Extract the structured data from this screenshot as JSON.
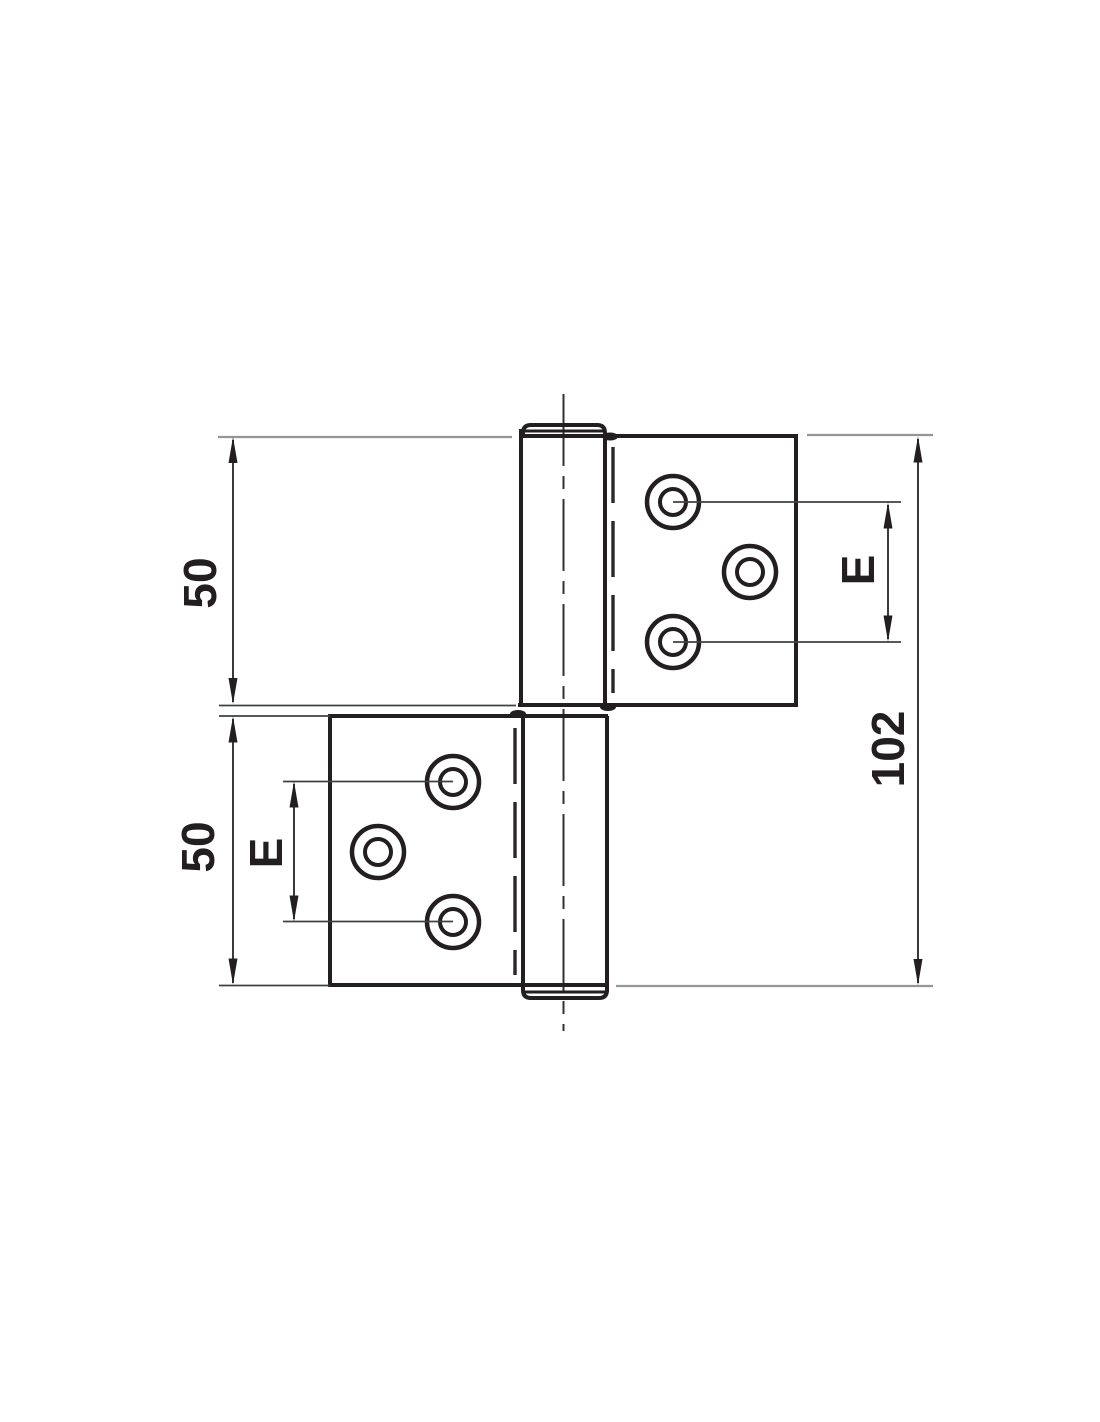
{
  "drawing": {
    "labels": {
      "top_leaf_height": "50",
      "bottom_leaf_height": "50",
      "overall_height": "102",
      "hole_spacing_right": "E",
      "hole_spacing_left": "E"
    },
    "colors": {
      "object_line": "#231f20",
      "thin_line": "#3f4042",
      "extension_line": "#939598",
      "background": "#ffffff"
    }
  }
}
